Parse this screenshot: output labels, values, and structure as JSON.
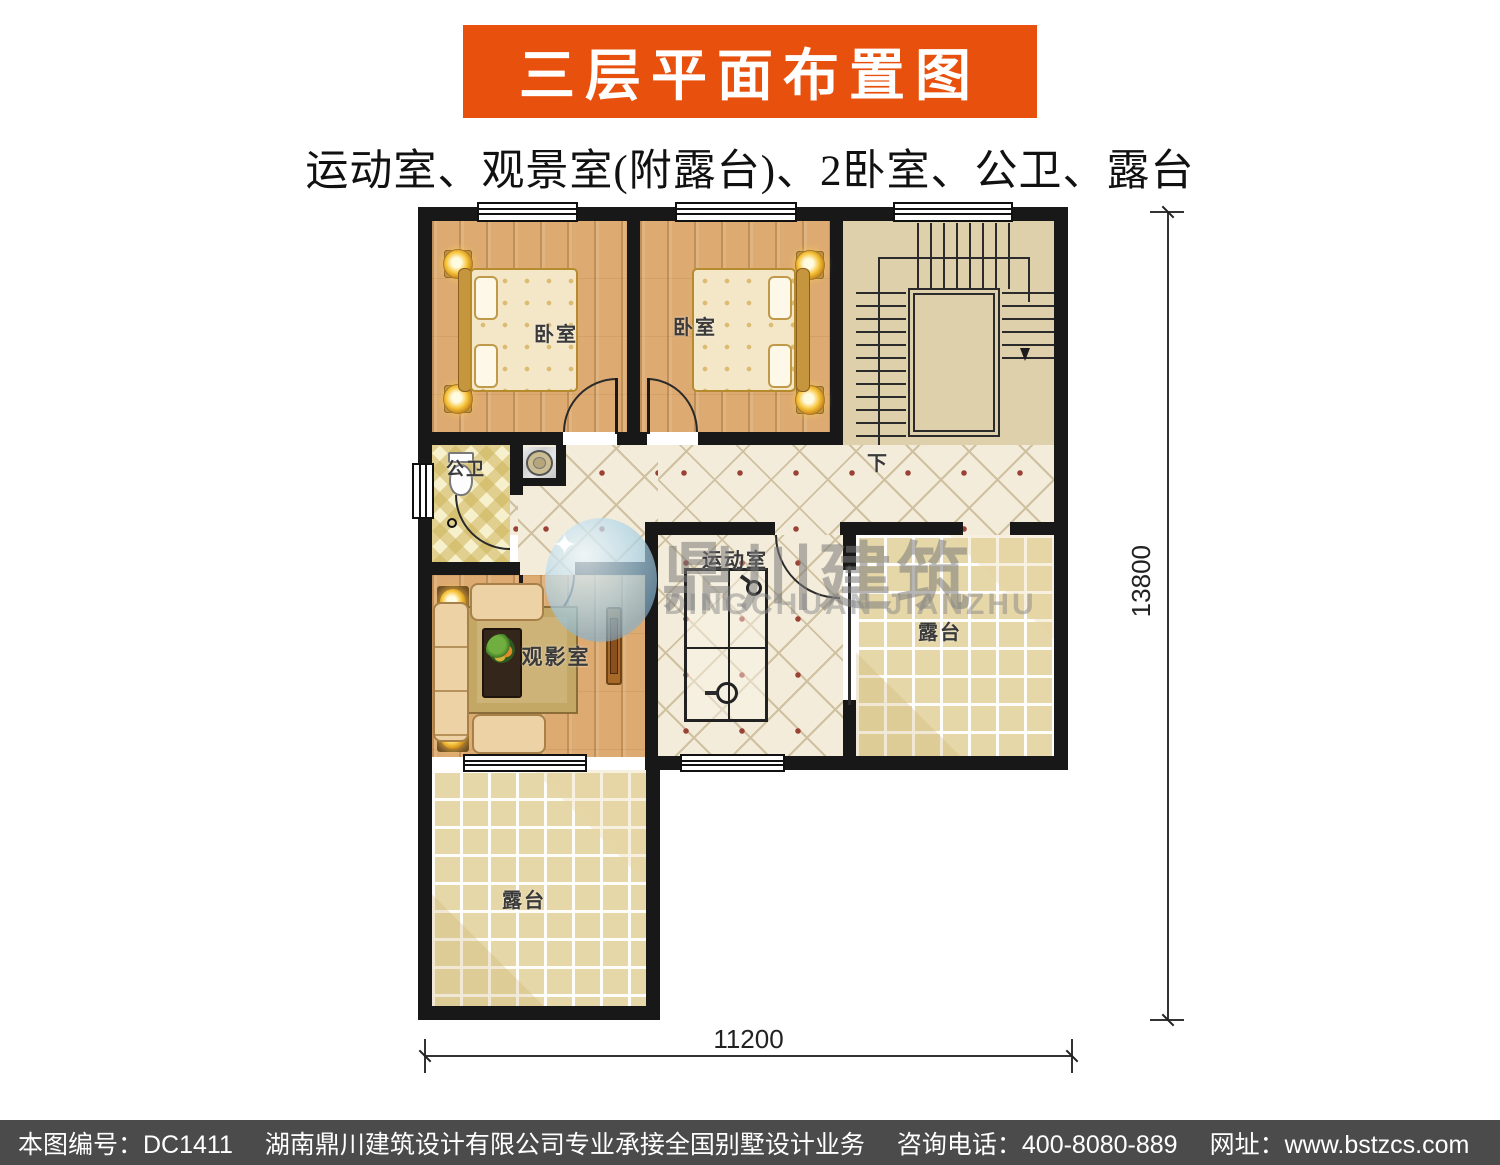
{
  "header": {
    "title": "三层平面布置图"
  },
  "subtitle": "运动室、观景室(附露台)、2卧室、公卫、露台",
  "plan": {
    "rooms": [
      {
        "id": "bedroom-1",
        "label": "卧室"
      },
      {
        "id": "bedroom-2",
        "label": "卧室"
      },
      {
        "id": "bathroom",
        "label": "公卫"
      },
      {
        "id": "stairs-down",
        "label": "下"
      },
      {
        "id": "gym",
        "label": "运动室"
      },
      {
        "id": "media-room",
        "label": "观影室"
      },
      {
        "id": "terrace-right",
        "label": "露台"
      },
      {
        "id": "terrace-bottom",
        "label": "露台"
      }
    ],
    "dimensions": {
      "right_mm": "13800",
      "bottom_mm": "11200"
    }
  },
  "watermark": {
    "cn": "鼎川建筑",
    "en": "DINGCHUAN JIANZHU",
    "sparkle": "✦"
  },
  "footer": {
    "drawing_no": "本图编号：DC1411",
    "company": "湖南鼎川建筑设计有限公司专业承接全国别墅设计业务",
    "phone": "咨询电话：400-8080-889",
    "website": "网址：www.bstzcs.com"
  },
  "colors": {
    "banner_orange": "#e8500e",
    "footer_gray": "#4b4b4b",
    "wall_black": "#181818",
    "wood_floor": "#ddab72",
    "tile_cream": "#f3ecda",
    "terrace_tan": "#e6d7a8",
    "stairs_beige": "#ddd0ab"
  }
}
